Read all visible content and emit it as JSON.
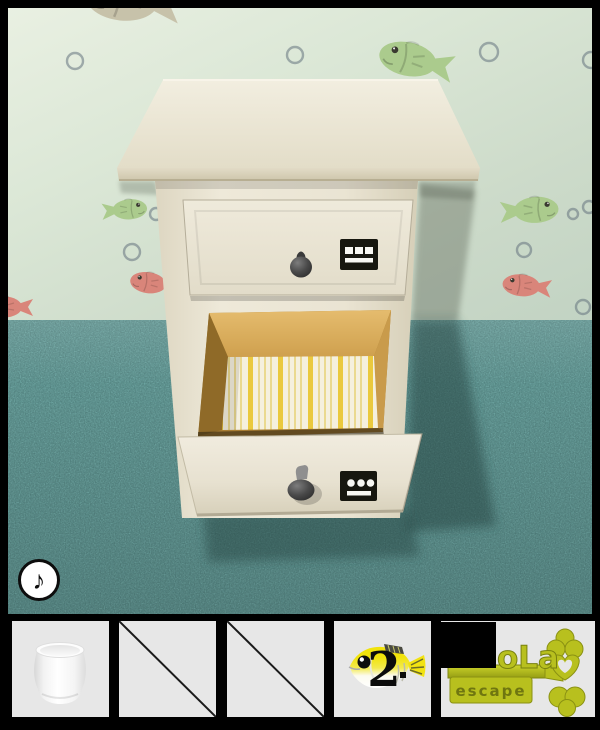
{
  "scene": {
    "music_button": {
      "symbol": "♪",
      "icon": "music-note-icon"
    },
    "cabinet": {
      "top_drawer": {
        "state": "closed",
        "sign_glyph": "three-squares-above-bar",
        "knob": "dark-round-knob"
      },
      "bottom_drawer": {
        "state": "open",
        "sign_glyph": "three-dots-above-bar",
        "knob": "dark-round-knob",
        "lining": "yellow-white striped paper"
      }
    },
    "wallpaper": {
      "motifs": [
        "green-fish",
        "red-fish",
        "beige-fish",
        "bubbles"
      ]
    }
  },
  "inventory": {
    "slots": [
      {
        "id": "slot-1",
        "item": "white-cup",
        "state": "filled"
      },
      {
        "id": "slot-2",
        "item": "empty",
        "state": "empty"
      },
      {
        "id": "slot-3",
        "item": "empty",
        "state": "empty"
      },
      {
        "id": "slot-4",
        "item": "fish-counter",
        "state": "filled",
        "label": "2"
      },
      {
        "id": "slot-5",
        "item": "brand-key-logo",
        "state": "filled",
        "brand": "oLa",
        "tagline": "escape"
      }
    ]
  },
  "colors": {
    "wall": "#d6e2d1",
    "floor": "#4d7e7b",
    "cabinet": "#eae4d3",
    "wood": "#cb9c4a",
    "stripe_yellow": "#eac93e",
    "logo_green": "#b8c01e",
    "fish_yellow": "#f1e30b",
    "fish_green": "#abcb8d",
    "fish_red": "#d9857a",
    "slot_bg": "#e7e7e7",
    "frame": "#000000"
  }
}
